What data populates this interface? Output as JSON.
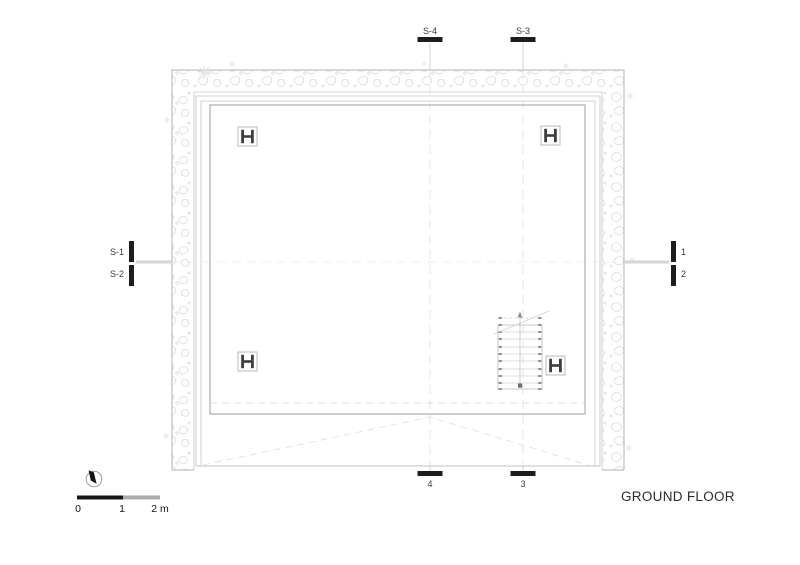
{
  "drawing": {
    "title": "GROUND FLOOR"
  },
  "section_markers": {
    "top": [
      {
        "label": "S-4"
      },
      {
        "label": "S-3"
      }
    ],
    "left": [
      {
        "label": "S-1"
      },
      {
        "label": "S-2"
      }
    ],
    "right": [
      {
        "label": "1"
      },
      {
        "label": "2"
      }
    ],
    "bottom": [
      {
        "label": "4"
      },
      {
        "label": "3"
      }
    ]
  },
  "scale_bar": {
    "tick_labels": [
      "0",
      "1",
      "2 m"
    ]
  },
  "plan": {
    "column_count": 4,
    "column_symbol": "steel-H-profile",
    "stair_direction": "up",
    "wall_hatch": "rubble-stone"
  },
  "colors": {
    "background": "#ffffff",
    "marker_black": "#1d1d1d",
    "wall_line": "#b2b2b2",
    "hatch_line": "#dadada",
    "room_line": "#9c9c9c",
    "scale_black": "#171717",
    "scale_gray": "#ababab",
    "title_text": "#2b2b2b"
  }
}
